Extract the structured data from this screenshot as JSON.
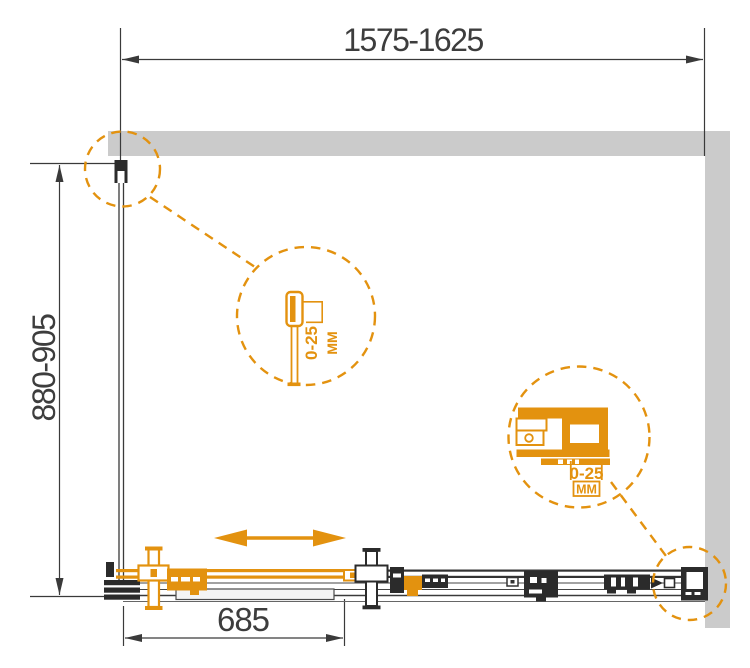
{
  "dimensions": {
    "width_range": "1575-1625",
    "depth_range": "880-905",
    "door_width": "685"
  },
  "details": {
    "wall_profile": {
      "adjustment": "0-25",
      "unit": "ММ"
    },
    "corner_connector": {
      "adjustment": "0-25",
      "unit": "ММ"
    }
  },
  "colors": {
    "accent_orange": "#e3920f",
    "wall_gray": "#cbcbcb",
    "line_dark": "#3a3a3a",
    "part_black": "#2b2b2b"
  }
}
